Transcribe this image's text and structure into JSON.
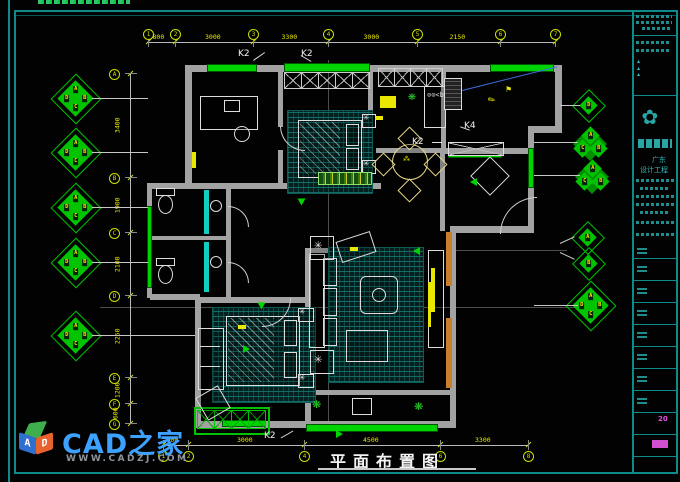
{
  "page": {
    "title": "平面布置图"
  },
  "watermark": {
    "brand": "CAD之家",
    "url": "WWW.CADZJ.COM",
    "cube": {
      "left_letter": "A",
      "right_letter": "D"
    }
  },
  "labels": {
    "k2": "K2",
    "k4": "K4"
  },
  "axes": {
    "top": {
      "bubbles": [
        "1",
        "2",
        "3",
        "4",
        "5",
        "6",
        "7"
      ],
      "dims": [
        "800",
        "3000",
        "3300",
        "3000",
        "2150",
        ""
      ]
    },
    "bottom": {
      "bubbles": [
        "1",
        "2",
        "4",
        "6",
        "8"
      ],
      "dims": [
        "600",
        "3000",
        "4500",
        "3300"
      ]
    },
    "left": {
      "bubbles": [
        "A",
        "B",
        "C",
        "D",
        "E",
        "F",
        "G"
      ],
      "dims": [
        "3400",
        "1900",
        "2100",
        "2250",
        "1200",
        "600"
      ]
    }
  },
  "markers": {
    "left": [
      {
        "type": "quad",
        "letters": [
          "A",
          "D",
          "B",
          "C"
        ]
      },
      {
        "type": "quad",
        "letters": [
          "A",
          "D",
          "B",
          "C"
        ]
      },
      {
        "type": "quad",
        "letters": [
          "A",
          "D",
          "B",
          "C"
        ]
      },
      {
        "type": "quad",
        "letters": [
          "A",
          "D",
          "B",
          "C"
        ]
      },
      {
        "type": "quad",
        "letters": [
          "A",
          "D",
          "B",
          "C"
        ]
      }
    ],
    "right": [
      {
        "type": "single",
        "letters": [
          "D"
        ]
      },
      {
        "type": "triple",
        "letters": [
          "A",
          "C",
          "B"
        ]
      },
      {
        "type": "triple",
        "letters": [
          "A",
          "C",
          "B"
        ]
      },
      {
        "type": "single",
        "letters": [
          "A"
        ]
      },
      {
        "type": "single",
        "letters": [
          "B"
        ]
      },
      {
        "type": "quad",
        "letters": [
          "A",
          "D",
          "B",
          "C"
        ]
      }
    ]
  },
  "title_block": {
    "company_line1": "广东",
    "company_line2": "设计工程",
    "year": "20"
  }
}
